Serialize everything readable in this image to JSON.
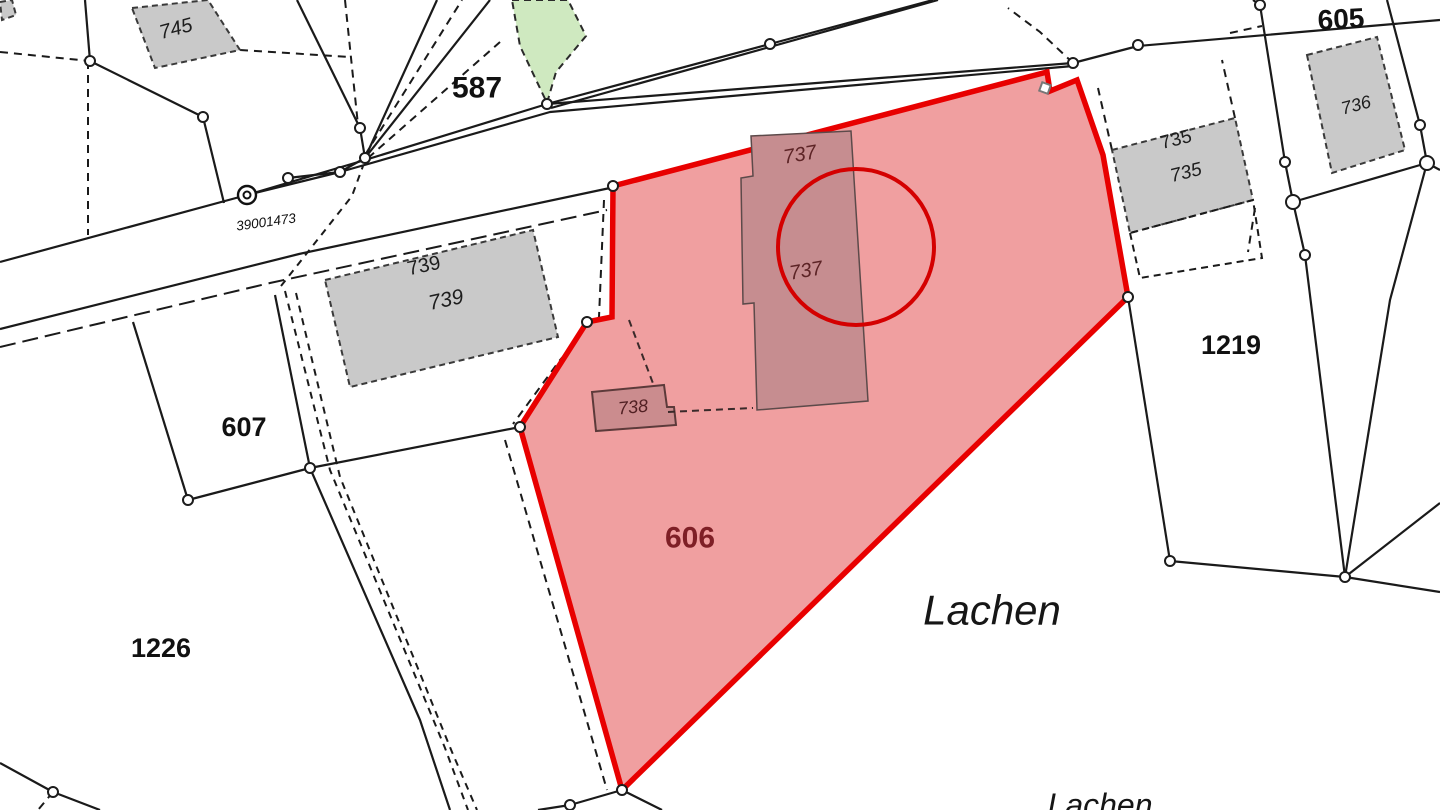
{
  "map": {
    "title": "cadastral-parcel-map",
    "place_name": "Lachen",
    "highlighted_parcel": "606",
    "parcel_numbers": [
      "745",
      "587",
      "605",
      "736",
      "735",
      "739",
      "737",
      "738",
      "606",
      "607",
      "1219",
      "1226"
    ],
    "survey_point_id": "39001473",
    "colors": {
      "background": "#ffffff",
      "line": "#1a1a1a",
      "highlight_stroke": "#e80000",
      "highlight_fill": "#f09fa0",
      "building_gray": "#c9c9c9",
      "building_red": "#c68d90",
      "green_area": "#cfe9c0",
      "label_dark_red": "#7e1f26"
    },
    "labels": [
      {
        "t": "745",
        "x": 176,
        "y": 29,
        "s": 20,
        "r": -15,
        "st": "italic",
        "c": "#1d1d1d"
      },
      {
        "t": "587",
        "x": 477,
        "y": 88,
        "s": 30,
        "r": 0,
        "st": "bold",
        "c": "#111111"
      },
      {
        "t": "39001473",
        "x": 266,
        "y": 222,
        "s": 13.5,
        "r": -8,
        "st": "italic",
        "c": "#111111"
      },
      {
        "t": "739",
        "x": 424,
        "y": 266,
        "s": 20,
        "r": -12,
        "st": "regular",
        "c": "#1d1d1d"
      },
      {
        "t": "739",
        "x": 446,
        "y": 300,
        "s": 21,
        "r": -12,
        "st": "italic",
        "c": "#1d1d1d"
      },
      {
        "t": "737",
        "x": 800,
        "y": 155,
        "s": 20,
        "r": -10,
        "st": "italic",
        "c": "#5d2426"
      },
      {
        "t": "737",
        "x": 806,
        "y": 271,
        "s": 20,
        "r": -10,
        "st": "italic",
        "c": "#5d2426"
      },
      {
        "t": "738",
        "x": 633,
        "y": 407,
        "s": 18,
        "r": -6,
        "st": "italic",
        "c": "#512023"
      },
      {
        "t": "735",
        "x": 1176,
        "y": 140,
        "s": 19,
        "r": -14,
        "st": "regular",
        "c": "#1d1d1d"
      },
      {
        "t": "735",
        "x": 1186,
        "y": 173,
        "s": 19,
        "r": -14,
        "st": "italic",
        "c": "#1d1d1d"
      },
      {
        "t": "736",
        "x": 1356,
        "y": 105,
        "s": 18,
        "r": -15,
        "st": "italic",
        "c": "#1d1d1d"
      },
      {
        "t": "605",
        "x": 1341,
        "y": 19,
        "s": 28,
        "r": -3,
        "st": "bold",
        "c": "#111111"
      },
      {
        "t": "1219",
        "x": 1231,
        "y": 345,
        "s": 27,
        "r": 0,
        "st": "bold",
        "c": "#111111"
      },
      {
        "t": "607",
        "x": 244,
        "y": 427,
        "s": 27,
        "r": 0,
        "st": "bold",
        "c": "#111111"
      },
      {
        "t": "1226",
        "x": 161,
        "y": 648,
        "s": 27,
        "r": 0,
        "st": "bold",
        "c": "#111111"
      },
      {
        "t": "606",
        "x": 690,
        "y": 538,
        "s": 30,
        "r": 0,
        "st": "bold",
        "c": "#7e1f26"
      },
      {
        "t": "Lachen",
        "x": 992,
        "y": 610,
        "s": 42,
        "r": 0,
        "st": "italic",
        "c": "#161616"
      },
      {
        "t": "Lachen",
        "x": 1100,
        "y": 805,
        "s": 32,
        "r": 0,
        "st": "italic",
        "c": "#161616"
      }
    ],
    "highlight_parcel": {
      "name": "parcel-606",
      "points": "613,186 1047,72 1050,91 1077,80 1103,155 1128,297 622,790 520,427 587,322 612,317",
      "fill": "#f09fa0",
      "stroke": "#e80000",
      "stroke_width": 5.5
    },
    "red_circle": {
      "cx": 856,
      "cy": 247,
      "r": 78,
      "stroke": "#d40000",
      "w": 4
    },
    "buildings_gray": [
      {
        "name": "building-745",
        "points": "132,8 208,0 240,50 155,68"
      },
      {
        "name": "building-739",
        "points": "325,280 533,230 558,337 350,387"
      },
      {
        "name": "building-735",
        "points": "1112,150 1235,118 1253,200 1130,233"
      },
      {
        "name": "building-736",
        "points": "1307,55 1377,37 1405,150 1332,173"
      },
      {
        "name": "building-fragment-topleft",
        "points": "0,2 12,0 16,15 2,20"
      }
    ],
    "buildings_red": [
      {
        "name": "building-737",
        "points": "851,131 868,401 757,410 754,303 743,304 741,178 753,176 751,136",
        "fill": "#c68d90",
        "stroke": "#5c4a4a",
        "w": 1.5
      },
      {
        "name": "building-738",
        "points": "592,392 664,385 667,407 674,407 676,425 596,431",
        "fill": "#cb8c8e",
        "stroke": "#5c3a3a",
        "w": 2
      }
    ],
    "green_area": {
      "name": "green-area",
      "points": "512,0 568,0 586,36 556,72 547,103 520,46",
      "fill": "#cfe9c0"
    },
    "lines": {
      "solid": [
        "0,262 247,195 365,160 547,104 1073,63",
        "1073,63 1138,46 1440,20",
        "340,172 550,112 1073,66",
        "547,104 770,44 933,0",
        "551,108 938,0",
        "297,0 360,128",
        "365,158 437,0",
        "365,158 490,0",
        "545,0 547,103",
        "85,0 90,61",
        "90,61 203,117 224,203",
        "288,178 340,172 365,158",
        "340,172 247,195",
        "360,128 365,158",
        "0,329 299,254 610,188",
        "133,322 188,500",
        "188,500 310,468 520,427",
        "275,295 310,468 420,720 450,810",
        "0,763 53,792 100,810",
        "622,790 570,805 538,810",
        "622,790 662,810",
        "1128,297 1170,561",
        "1170,561 1345,577 1440,592",
        "1305,255 1345,577",
        "1260,5 1285,162 1293,202 1305,255",
        "1293,202 1427,163",
        "1387,0 1420,125 1427,163",
        "1427,163 1440,170",
        "1427,163 1390,300 1345,577",
        "1345,577 1440,503",
        "1253,0 1260,5"
      ],
      "dashed": [
        {
          "p": "0,52 90,61"
        },
        {
          "p": "88,61 88,235"
        },
        {
          "p": "240,50 350,57"
        },
        {
          "p": "345,0 358,125"
        },
        {
          "p": "365,155 462,0"
        },
        {
          "p": "368,158 500,42"
        },
        {
          "p": "0,347 270,283 607,210",
          "d": "16 7"
        },
        {
          "p": "285,291 330,470 445,748 468,810",
          "d": "7 6"
        },
        {
          "p": "296,293 340,477 452,752 477,810",
          "d": "7 6"
        },
        {
          "p": "281,286 352,196 363,166",
          "d": "7 6"
        },
        {
          "p": "604,200 599,317 560,360 513,424"
        },
        {
          "p": "505,440 607,790"
        },
        {
          "p": "1112,150 1098,88"
        },
        {
          "p": "1235,118 1222,60"
        },
        {
          "p": "1230,33 1262,26"
        },
        {
          "p": "1255,208 1248,252"
        },
        {
          "p": "1073,63 1040,32 1008,8"
        },
        {
          "p": "53,792 38,810"
        }
      ],
      "dashed_over": [
        {
          "p": "629,320 654,386"
        },
        {
          "p": "668,412 753,408"
        }
      ],
      "dashed_polygons": [
        {
          "name": "dashed-extension-735",
          "points": "1130,233 1140,278 1262,258 1253,200"
        }
      ]
    },
    "vertices": [
      {
        "x": 90,
        "y": 61
      },
      {
        "x": 203,
        "y": 117
      },
      {
        "x": 360,
        "y": 128
      },
      {
        "x": 365,
        "y": 158
      },
      {
        "x": 340,
        "y": 172
      },
      {
        "x": 288,
        "y": 178
      },
      {
        "x": 547,
        "y": 104
      },
      {
        "x": 770,
        "y": 44
      },
      {
        "x": 1073,
        "y": 63
      },
      {
        "x": 1138,
        "y": 45
      },
      {
        "x": 613,
        "y": 186
      },
      {
        "x": 1128,
        "y": 297
      },
      {
        "x": 622,
        "y": 790
      },
      {
        "x": 520,
        "y": 427
      },
      {
        "x": 587,
        "y": 322
      },
      {
        "x": 188,
        "y": 500
      },
      {
        "x": 310,
        "y": 468
      },
      {
        "x": 53,
        "y": 792
      },
      {
        "x": 1170,
        "y": 561
      },
      {
        "x": 1345,
        "y": 577
      },
      {
        "x": 1260,
        "y": 5
      },
      {
        "x": 1285,
        "y": 162
      },
      {
        "x": 1305,
        "y": 255
      },
      {
        "x": 1420,
        "y": 125
      },
      {
        "x": 570,
        "y": 805
      },
      {
        "x": 1293,
        "y": 202,
        "r": 7
      },
      {
        "x": 1427,
        "y": 163,
        "r": 7
      }
    ],
    "special_markers": {
      "double_circle_point": {
        "x": 247,
        "y": 195,
        "label": "39001473"
      },
      "square_marker": {
        "x": 1045,
        "y": 88,
        "rot": 20
      }
    }
  }
}
